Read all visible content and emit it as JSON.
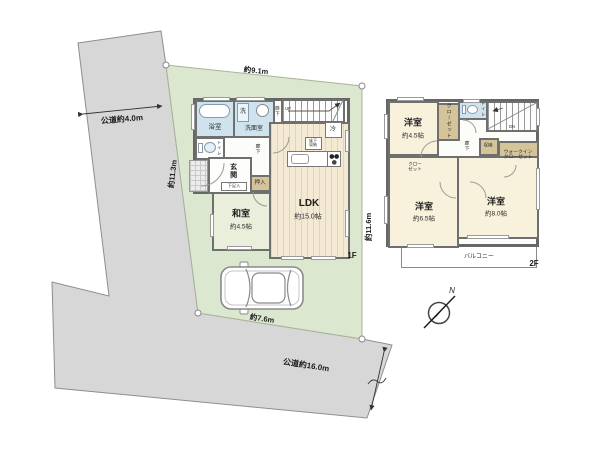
{
  "site": {
    "road_left_label": "公道約4.0m",
    "road_bottom_label": "公道約16.0m",
    "dim_top": "約9.1m",
    "dim_left": "約11.3m",
    "dim_right": "約11.6m",
    "dim_bottom": "約7.6m",
    "north_label": "N"
  },
  "floor1": {
    "floor_label": "1F",
    "bath": "浴室",
    "washroom": "洗面室",
    "washer": "洗",
    "hall_upper": "廊下",
    "stairs_up": "UP",
    "fridge": "冷",
    "toilet": "トイレ",
    "entrance": "玄関",
    "shoe_box": "下足入",
    "closet_oshiire": "押入",
    "hall_mid": "廊下",
    "floor_storage_line1": "床下",
    "floor_storage_line2": "収納",
    "japanese_room": "和室",
    "japanese_room_size": "約4.5帖",
    "ldk": "LDK",
    "ldk_size": "約15.0帖"
  },
  "floor2": {
    "floor_label": "2F",
    "bedroom1": "洋室",
    "bedroom1_size": "約4.5帖",
    "closet1": "クローゼット",
    "toilet": "トイレ",
    "stairs_down": "DN",
    "hall": "廊下",
    "storage": "収納",
    "wic_line1": "ウォークイン",
    "wic_line2": "クローゼット",
    "closet2_line1": "クロー",
    "closet2_line2": "ゼット",
    "bedroom2": "洋室",
    "bedroom2_size": "約6.5帖",
    "bedroom3": "洋室",
    "bedroom3_size": "約8.0帖",
    "balcony": "バルコニー"
  }
}
